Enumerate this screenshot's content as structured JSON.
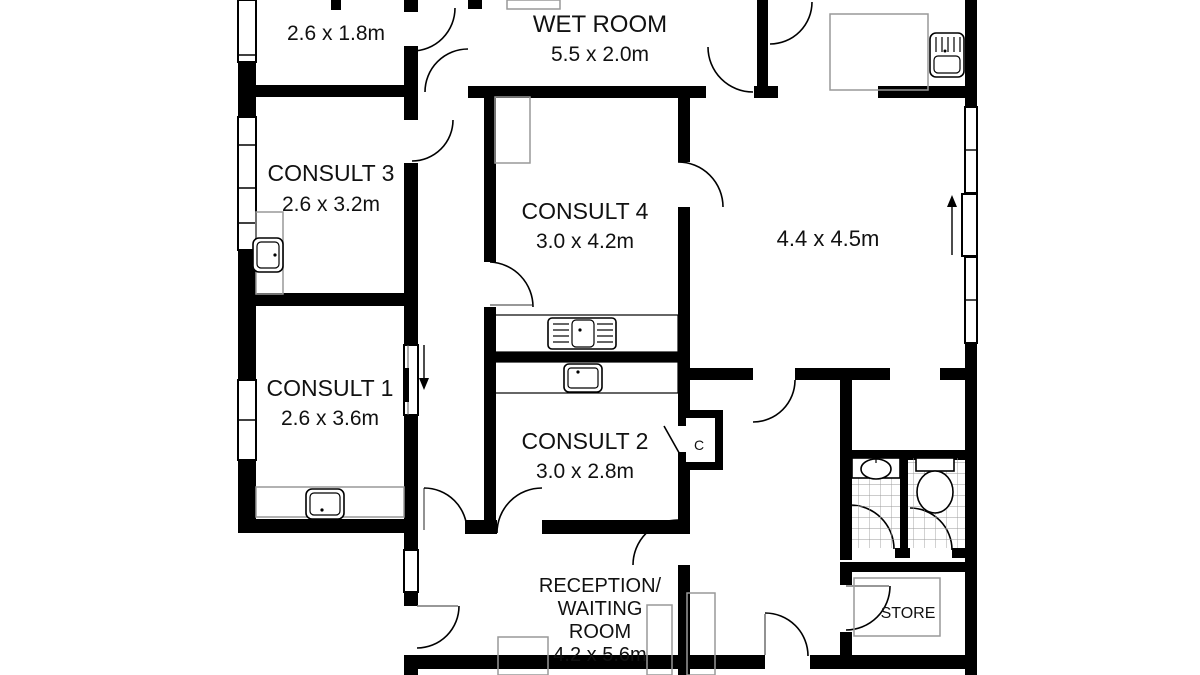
{
  "page": {
    "background": "#ffffff"
  },
  "colors": {
    "wall": "#000000",
    "furniture_outline": "#999999",
    "tile_line": "#9a9a9a",
    "text": "#111111"
  },
  "rooms": {
    "small_top_left": {
      "dims": "2.6 x 1.8m"
    },
    "wet_room": {
      "name": "WET ROOM",
      "dims": "5.5 x 2.0m"
    },
    "consult_3": {
      "name": "CONSULT 3",
      "dims": "2.6 x 3.2m"
    },
    "consult_4": {
      "name": "CONSULT 4",
      "dims": "3.0 x 4.2m"
    },
    "large_room": {
      "dims": "4.4 x 4.5m"
    },
    "consult_1": {
      "name": "CONSULT 1",
      "dims": "2.6 x 3.6m"
    },
    "consult_2": {
      "name": "CONSULT 2",
      "dims": "3.0 x 2.8m"
    },
    "reception": {
      "line1": "RECEPTION/",
      "line2": "WAITING",
      "line3": "ROOM",
      "dims": "4.2 x 5.6m"
    },
    "store": {
      "name": "STORE"
    },
    "cupboard": {
      "name": "C"
    }
  }
}
